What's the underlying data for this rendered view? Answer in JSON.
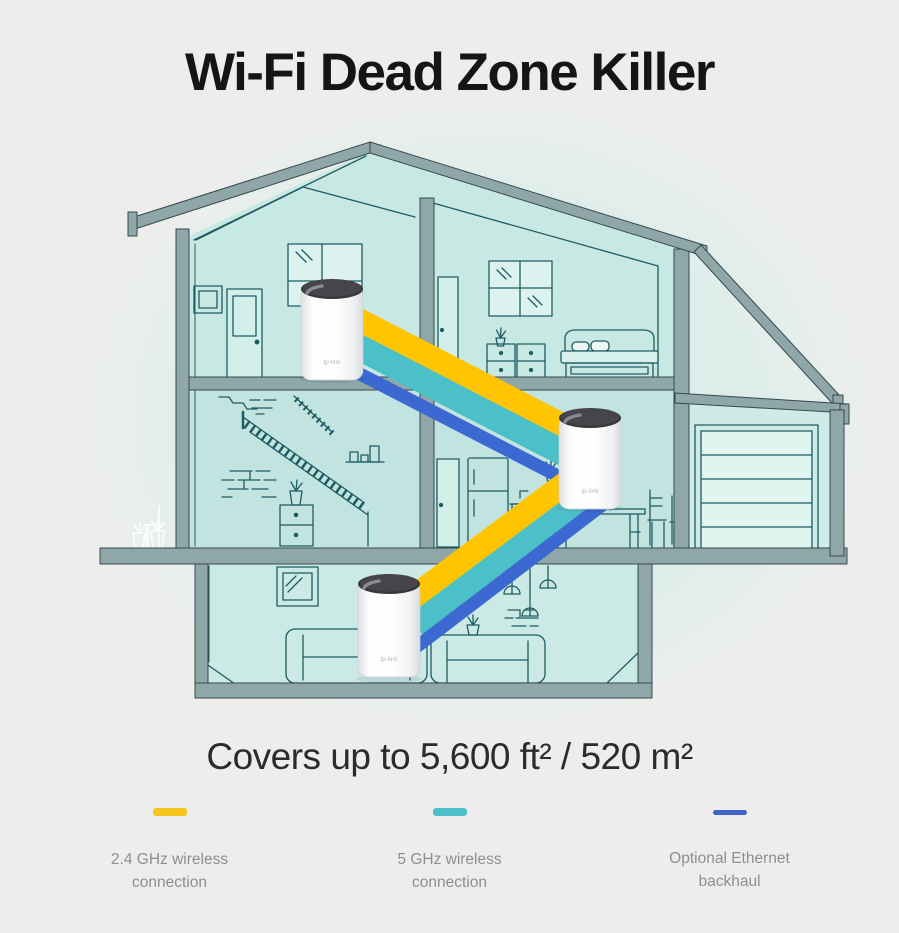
{
  "title": "Wi-Fi Dead Zone Killer",
  "coverage_text": "Covers up to 5,600 ft² / 520 m²",
  "legend": {
    "items": [
      {
        "key": "wireless24",
        "color": "#F6C51D",
        "label": "2.4 GHz wireless connection"
      },
      {
        "key": "wireless5",
        "color": "#4CC0C8",
        "label": "5 GHz wireless connection"
      },
      {
        "key": "ethernet",
        "color": "#3E63C9",
        "label": "Optional Ethernet backhaul"
      }
    ]
  },
  "illustration": {
    "band_colors": {
      "wireless24": "#FFC402",
      "wireless5": "#4CC0C8",
      "ethernet": "#3C68D2"
    },
    "units": [
      {
        "name": "deco-unit-attic",
        "brand": "tp-link"
      },
      {
        "name": "deco-unit-middle",
        "brand": "tp-link"
      },
      {
        "name": "deco-unit-ground",
        "brand": "tp-link"
      }
    ]
  }
}
